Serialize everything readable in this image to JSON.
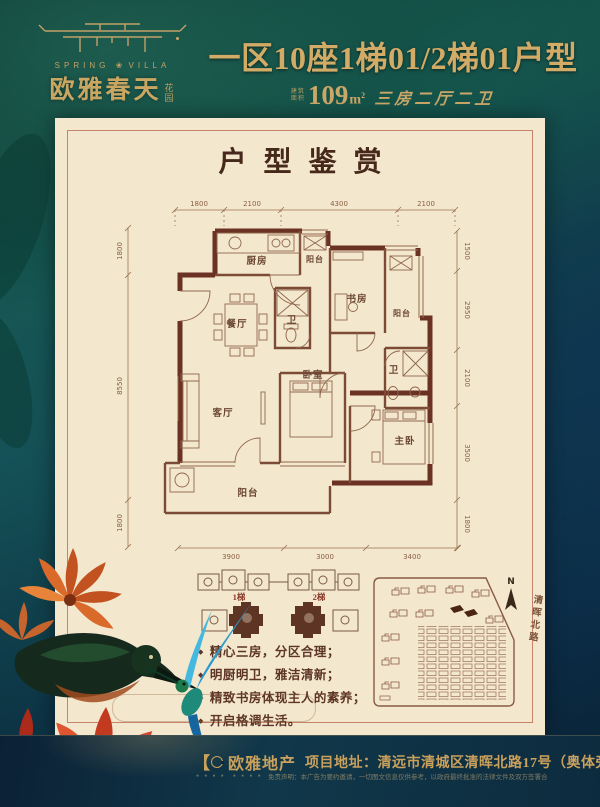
{
  "header": {
    "logo_en_left": "SPRING",
    "logo_flower": "❀",
    "logo_en_right": "VILLA",
    "logo_cn": "欧雅春天",
    "logo_cn_small": "花园",
    "title": "一区10座1梯01/2梯01户型",
    "area_prefix": "建筑面积",
    "area_value": "109",
    "area_unit": "m",
    "area_sup": "2",
    "area_desc": "三房二厅二卫"
  },
  "panel": {
    "title": "户型鉴赏"
  },
  "plan": {
    "dims": {
      "top": [
        "1800",
        "2100",
        "4300",
        "2100"
      ],
      "bottom": [
        "3900",
        "3000",
        "3400"
      ],
      "left": [
        "1800",
        "8550",
        "1800"
      ],
      "right": [
        "1500",
        "2950",
        "2100",
        "3500",
        "1800"
      ]
    },
    "rooms": {
      "kitchen": "厨房",
      "balcony_top": "阳台",
      "dining": "餐厅",
      "bath1": "卫",
      "study": "书房",
      "balcony_right": "阳台",
      "living": "客厅",
      "bedroom": "卧室",
      "bath2": "卫",
      "master": "主卧",
      "balcony_bottom": "阳台"
    }
  },
  "keyplan": {
    "lift1": "1梯",
    "lift2": "2梯"
  },
  "features": {
    "bullet": "◆",
    "items": [
      "精心三房，分区合理；",
      "明厨明卫，雅洁清新；",
      "精致书房体现主人的素养；",
      "开启格调生活。"
    ]
  },
  "sitemap": {
    "north_label": "N",
    "road_label": "清晖北路"
  },
  "footer": {
    "bracket": "【",
    "brand": "欧雅地产",
    "address": "项目地址：清远市清城区清晖北路17号（奥体旁）",
    "marks": "● ● ● ●　● ● ● ●",
    "disclaimer": "免责声明：本广告为要约邀请，一切图文信息仅供参考，以政府最终批准的法律文件及双方签署合同为准。"
  },
  "colors": {
    "gold": "#c9a763",
    "cream": "#f3e7ce",
    "wall_brown": "#6b3224",
    "teal_bg": "#123c38",
    "footer_navy": "#0d2b3e",
    "accent_red": "#b5402a"
  }
}
